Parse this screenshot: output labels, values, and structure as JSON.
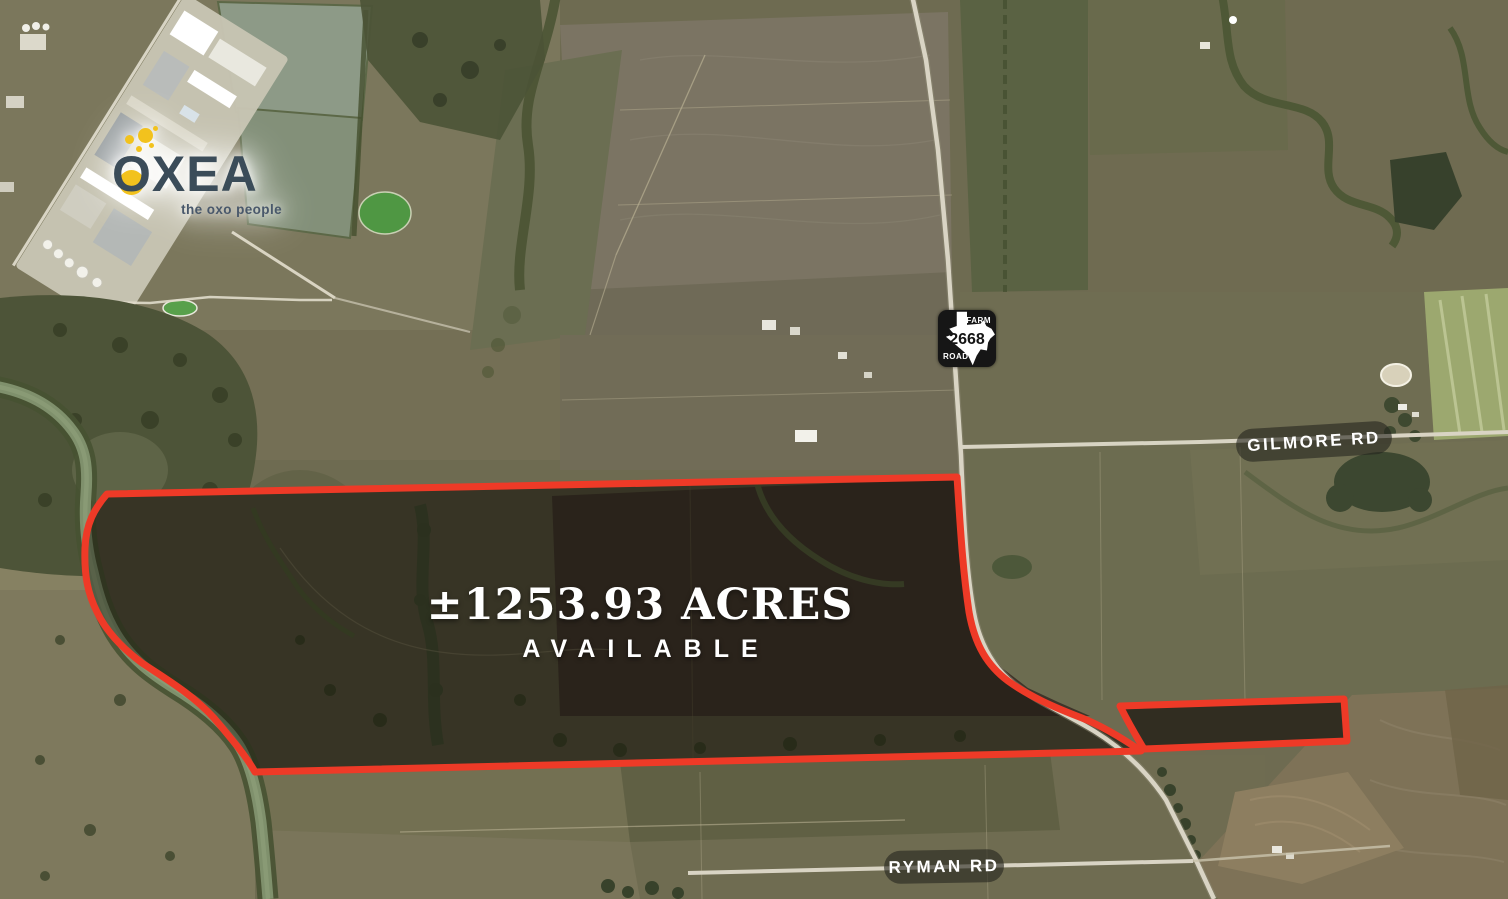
{
  "map": {
    "branding": {
      "name": "OXEA",
      "tagline": "the oxo people"
    },
    "parcel_label": {
      "acreage": "±1253.93 ACRES",
      "status": "AVAILABLE"
    },
    "road_sign": {
      "top": "FARM",
      "number": "2668",
      "bottom": "ROAD"
    },
    "road_labels": {
      "gilmore": "GILMORE RD",
      "ryman": "RYMAN RD"
    },
    "colors": {
      "boundary_red": "#ee3a27",
      "pill_background": "rgba(36,36,30,0.6)",
      "label_text": "#ffffff",
      "logo_text": "#3b4c59",
      "bubble_yellow": "#f2c21d",
      "sign_background": "#161616",
      "river_water": "#7f906c",
      "road_surface": "#d9d4c4"
    }
  }
}
